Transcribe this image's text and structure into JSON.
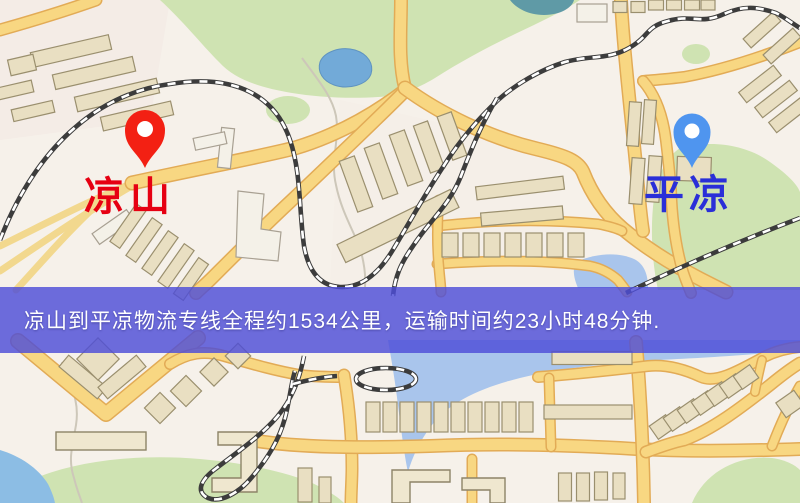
{
  "banner": {
    "text": "凉山到平凉物流专线全程约1534公里，运输时间约23小时48分钟."
  },
  "route": {
    "origin": "凉山",
    "destination": "平凉",
    "distance": "1534公里",
    "duration": "23小时48分钟"
  },
  "markers": {
    "origin": {
      "label": "凉山"
    },
    "destination": {
      "label": "平凉"
    }
  },
  "theme": {
    "map-bg": "#f6f1ea",
    "road-fill": "#f8d782",
    "road-casing": "#e2ab56",
    "park-green": "#cfe3b2",
    "water-blue": "#a9c5ec",
    "rail-dark": "#3c3c3c",
    "banner-bg": "rgba(77,77,216,0.82)",
    "banner-text": "#ffffff",
    "origin-pin": "#f32013",
    "origin-label": "#e60012",
    "dest-pin": "#4f95ef",
    "dest-label": "#2a2fd8"
  }
}
